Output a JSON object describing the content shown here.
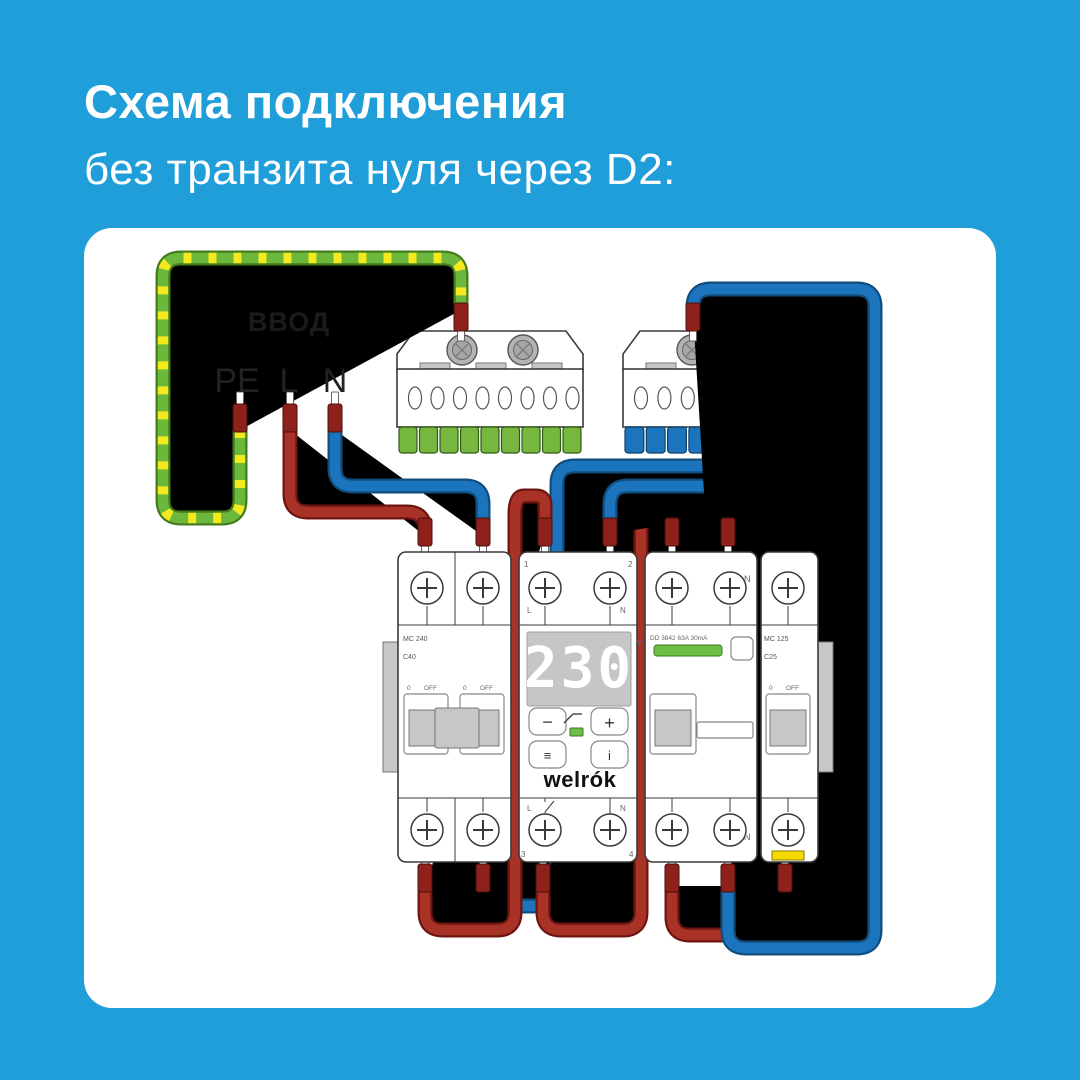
{
  "title": {
    "line1": "Схема подключения",
    "line2": "без транзита нуля через D2:"
  },
  "input": {
    "label": "ВВОД",
    "pe": "PE",
    "l": "L",
    "n": "N"
  },
  "devices": {
    "breaker_left": {
      "model": "MC 240",
      "rating": "C40",
      "pos": "0",
      "off": "OFF"
    },
    "relay": {
      "brand": "welrók",
      "display": "230",
      "unit": "V",
      "t1": "1",
      "t2": "2",
      "t3": "3",
      "t4": "4",
      "l": "L",
      "n": "N",
      "btn_minus": "−",
      "btn_plus": "+",
      "btn_menu": "≡",
      "btn_info": "i"
    },
    "rcd": {
      "label": "DD 3842 63A 30mA",
      "n": "N"
    },
    "breaker_right": {
      "model": "MC 125",
      "rating": "C25",
      "pos": "0",
      "off": "OFF"
    }
  },
  "colors": {
    "background": "#1F9ED9",
    "card": "#FFFFFF",
    "title_text": "#FFFFFF",
    "wire_red": "#A93226",
    "wire_blue": "#1B74BC",
    "wire_pe_green": "#6CB83C",
    "wire_pe_yellow": "#F4E81F",
    "ferrule": "#8E211B",
    "bus_pe": "#76B83F",
    "bus_n": "#1B74BC",
    "indicator_green": "#6CBE45",
    "marker_yellow": "#F5D800",
    "device_outline": "#3A3A3A",
    "display_bg": "#C5C7C7",
    "display_digits": "#FFFFFF",
    "part_gray": "#C7C7C7"
  }
}
